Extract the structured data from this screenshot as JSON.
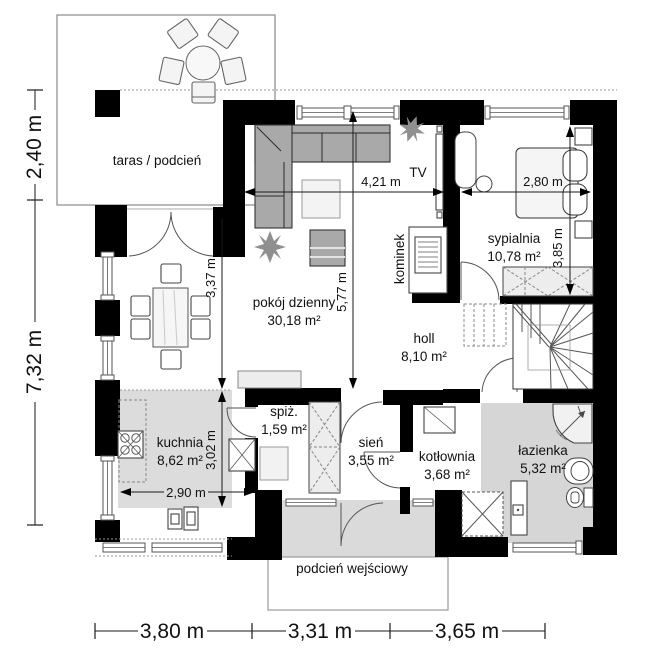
{
  "plan_type": "floor-plan",
  "rooms": {
    "taras": {
      "label": "taras / podcień"
    },
    "pokoj_dzienny": {
      "label": "pokój dzienny",
      "area": "30,18 m²"
    },
    "sypialnia": {
      "label": "sypialnia",
      "area": "10,78 m²"
    },
    "holl": {
      "label": "holl",
      "area": "8,10 m²"
    },
    "kuchnia": {
      "label": "kuchnia",
      "area": "8,62 m²"
    },
    "spiz": {
      "label": "spiż.",
      "area": "1,59 m²"
    },
    "sien": {
      "label": "sień",
      "area": "3,55 m²"
    },
    "kotlownia": {
      "label": "kotłownia",
      "area": "3,68 m²"
    },
    "lazienka": {
      "label": "łazienka",
      "area": "5,32 m²"
    },
    "podcien_wejsciowy": {
      "label": "podcień wejściowy"
    }
  },
  "features": {
    "kominek": "kominek",
    "tv": "TV"
  },
  "dimensions": {
    "terrace_depth": "2,40 m",
    "house_depth": "7,32 m",
    "bottom_left": "3,80 m",
    "bottom_middle": "3,31 m",
    "bottom_right": "3,65 m",
    "living_width": "4,21 m",
    "living_height": "5,77 m",
    "dining_height": "3,37 m",
    "bedroom_width": "2,80 m",
    "bedroom_height": "3,85 m",
    "kitchen_width": "2,90 m",
    "kitchen_height": "3,02 m"
  },
  "colors": {
    "wall": "#000000",
    "shaded_floor": "#d9d9d9",
    "furniture_gray": "#a9a9a9",
    "line": "#444444"
  }
}
